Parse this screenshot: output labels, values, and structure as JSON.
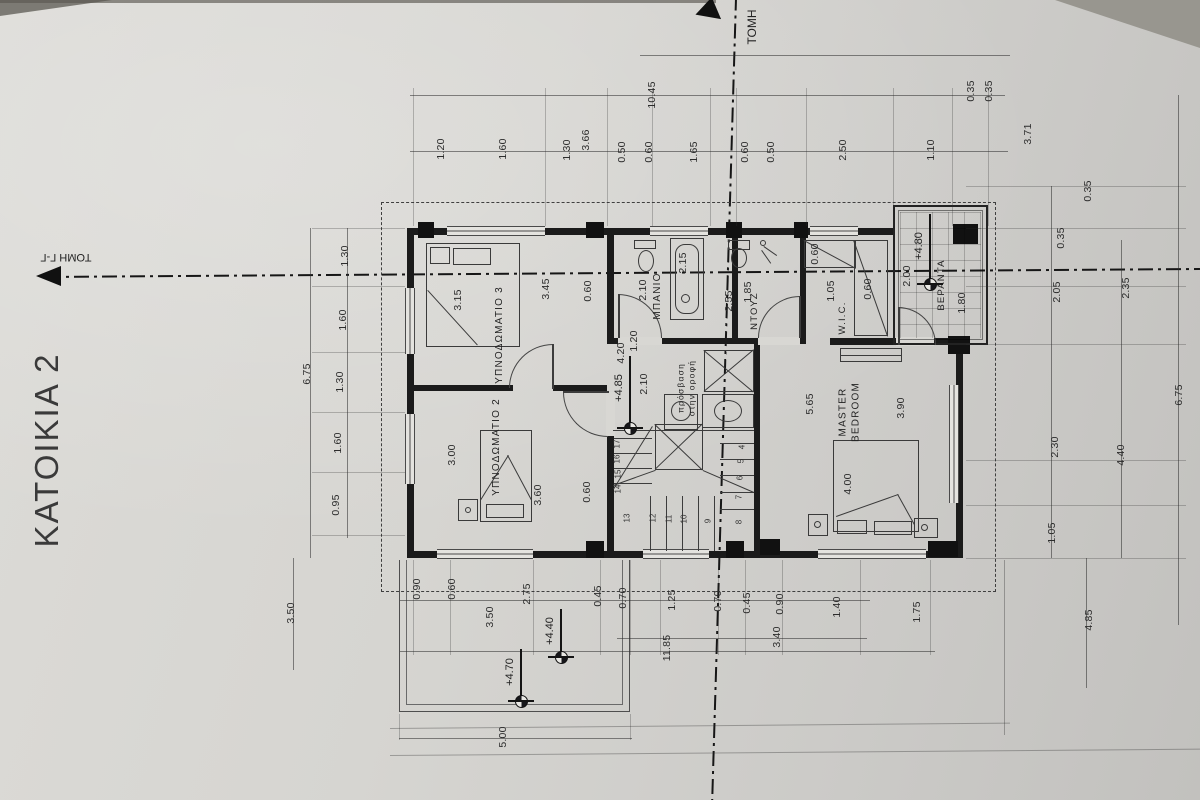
{
  "sheet": {
    "title": "ΚΑΤΟΙΚΙΑ 2",
    "section_top_label": "ΤΟΜΗ",
    "section_left_label": "ΤΟΜΗ Γ-Γ"
  },
  "palette": {
    "paper": "#d6d5d1",
    "ink": "#1b1b1b"
  },
  "room_labels": [
    {
      "text": "ΥΠΝΟΔΩΜΑΤΙΟ 3",
      "x": 500,
      "y": 335,
      "size": 10
    },
    {
      "text": "ΥΠΝΟΔΩΜΑΤΙΟ 2",
      "x": 497,
      "y": 447,
      "size": 10
    },
    {
      "text": "ΜΠΑΝΙΟ",
      "x": 658,
      "y": 296,
      "size": 10
    },
    {
      "text": "ΝΤΟΥΖ",
      "x": 755,
      "y": 311,
      "size": 9.5
    },
    {
      "text": "W.I.C.",
      "x": 843,
      "y": 318,
      "size": 9.5
    },
    {
      "text": "MASTER\nBEDROOM",
      "x": 850,
      "y": 412,
      "size": 10
    },
    {
      "text": "ΒΕΡΑΝΤΑ",
      "x": 942,
      "y": 285,
      "size": 9.5
    },
    {
      "text": "πρόσβαση\nστην οροφή",
      "x": 686,
      "y": 388,
      "size": 8.5
    }
  ],
  "level_markers": [
    {
      "text": "+4.85",
      "cx": 630,
      "cy": 428,
      "len": 72
    },
    {
      "text": "+4.80",
      "cx": 930,
      "cy": 284,
      "len": 70
    },
    {
      "text": "+4.70",
      "cx": 521,
      "cy": 701,
      "len": 52
    },
    {
      "text": "+4.40",
      "cx": 561,
      "cy": 657,
      "len": 48
    }
  ],
  "stair_steps": [
    {
      "n": "17",
      "x": 617,
      "y": 444
    },
    {
      "n": "16",
      "x": 617,
      "y": 459
    },
    {
      "n": "15",
      "x": 618,
      "y": 474
    },
    {
      "n": "14",
      "x": 618,
      "y": 489
    },
    {
      "n": "13",
      "x": 627,
      "y": 518
    },
    {
      "n": "12",
      "x": 653,
      "y": 518
    },
    {
      "n": "11",
      "x": 669,
      "y": 519
    },
    {
      "n": "10",
      "x": 684,
      "y": 519
    },
    {
      "n": "9",
      "x": 708,
      "y": 521
    },
    {
      "n": "8",
      "x": 739,
      "y": 522
    },
    {
      "n": "7",
      "x": 739,
      "y": 497
    },
    {
      "n": "6",
      "x": 740,
      "y": 478
    },
    {
      "n": "5",
      "x": 741,
      "y": 461
    },
    {
      "n": "4",
      "x": 742,
      "y": 447
    }
  ],
  "dim_labels": [
    {
      "t": "10.45",
      "x": 652,
      "y": 95
    },
    {
      "t": "1.20",
      "x": 441,
      "y": 149
    },
    {
      "t": "1.60",
      "x": 503,
      "y": 149
    },
    {
      "t": "1.30",
      "x": 567,
      "y": 150
    },
    {
      "t": "3.66",
      "x": 586,
      "y": 140
    },
    {
      "t": "0.50",
      "x": 622,
      "y": 152
    },
    {
      "t": "0.60",
      "x": 649,
      "y": 152
    },
    {
      "t": "1.65",
      "x": 694,
      "y": 152
    },
    {
      "t": "0.60",
      "x": 745,
      "y": 152
    },
    {
      "t": "0.50",
      "x": 771,
      "y": 152
    },
    {
      "t": "2.50",
      "x": 843,
      "y": 150
    },
    {
      "t": "1.10",
      "x": 931,
      "y": 150
    },
    {
      "t": "0.35",
      "x": 971,
      "y": 91
    },
    {
      "t": "0.35",
      "x": 989,
      "y": 91
    },
    {
      "t": "3.71",
      "x": 1028,
      "y": 134
    },
    {
      "t": "0.35",
      "x": 1088,
      "y": 191
    },
    {
      "t": "0.35",
      "x": 1061,
      "y": 238
    },
    {
      "t": "2.05",
      "x": 1057,
      "y": 292
    },
    {
      "t": "2.35",
      "x": 1126,
      "y": 288
    },
    {
      "t": "2.30",
      "x": 1055,
      "y": 447
    },
    {
      "t": "1.05",
      "x": 1052,
      "y": 533
    },
    {
      "t": "4.40",
      "x": 1121,
      "y": 455
    },
    {
      "t": "6.75",
      "x": 1179,
      "y": 395
    },
    {
      "t": "4.85",
      "x": 1089,
      "y": 620
    },
    {
      "t": "1.30",
      "x": 345,
      "y": 256
    },
    {
      "t": "1.60",
      "x": 343,
      "y": 320
    },
    {
      "t": "1.30",
      "x": 340,
      "y": 382
    },
    {
      "t": "1.60",
      "x": 338,
      "y": 443
    },
    {
      "t": "0.95",
      "x": 336,
      "y": 505
    },
    {
      "t": "6.75",
      "x": 307,
      "y": 374
    },
    {
      "t": "3.50",
      "x": 291,
      "y": 613
    },
    {
      "t": "0.90",
      "x": 417,
      "y": 589
    },
    {
      "t": "0.60",
      "x": 452,
      "y": 589
    },
    {
      "t": "3.50",
      "x": 490,
      "y": 617
    },
    {
      "t": "2.75",
      "x": 527,
      "y": 594
    },
    {
      "t": "0.45",
      "x": 598,
      "y": 596
    },
    {
      "t": "0.70",
      "x": 623,
      "y": 598
    },
    {
      "t": "1.25",
      "x": 672,
      "y": 600
    },
    {
      "t": "0.70",
      "x": 718,
      "y": 601
    },
    {
      "t": "0.45",
      "x": 747,
      "y": 603
    },
    {
      "t": "0.90",
      "x": 780,
      "y": 604
    },
    {
      "t": "1.40",
      "x": 837,
      "y": 607
    },
    {
      "t": "3.40",
      "x": 777,
      "y": 637
    },
    {
      "t": "11.85",
      "x": 667,
      "y": 648
    },
    {
      "t": "1.75",
      "x": 917,
      "y": 612
    },
    {
      "t": "5.00",
      "x": 503,
      "y": 737
    },
    {
      "t": "3.15",
      "x": 458,
      "y": 300
    },
    {
      "t": "3.45",
      "x": 546,
      "y": 289
    },
    {
      "t": "0.60",
      "x": 588,
      "y": 291
    },
    {
      "t": "3.00",
      "x": 452,
      "y": 455
    },
    {
      "t": "3.60",
      "x": 538,
      "y": 495
    },
    {
      "t": "0.60",
      "x": 587,
      "y": 492
    },
    {
      "t": "2.10",
      "x": 643,
      "y": 290
    },
    {
      "t": "2.15",
      "x": 683,
      "y": 263
    },
    {
      "t": "1.85",
      "x": 748,
      "y": 292
    },
    {
      "t": "2.55",
      "x": 729,
      "y": 301
    },
    {
      "t": "0.60",
      "x": 815,
      "y": 254
    },
    {
      "t": "1.05",
      "x": 831,
      "y": 291
    },
    {
      "t": "0.60",
      "x": 868,
      "y": 289
    },
    {
      "t": "5.65",
      "x": 810,
      "y": 404
    },
    {
      "t": "3.90",
      "x": 901,
      "y": 408
    },
    {
      "t": "4.00",
      "x": 848,
      "y": 484
    },
    {
      "t": "1.20",
      "x": 634,
      "y": 341
    },
    {
      "t": "4.20",
      "x": 621,
      "y": 353
    },
    {
      "t": "2.10",
      "x": 644,
      "y": 384
    },
    {
      "t": "2.00",
      "x": 907,
      "y": 276
    },
    {
      "t": "1.80",
      "x": 962,
      "y": 303
    }
  ]
}
